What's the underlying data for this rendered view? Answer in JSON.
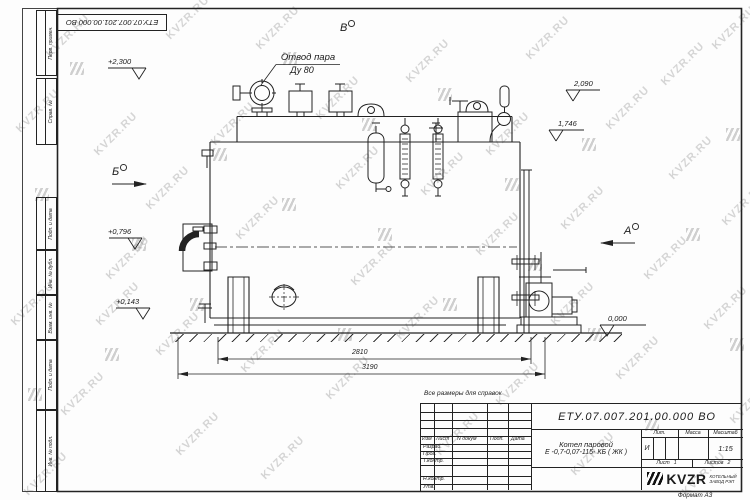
{
  "watermark_text": "KVZR.RU",
  "top_stamp": {
    "doc_number": "ЕТУ.07.007.201.00.000  ВО"
  },
  "margin": {
    "labels": {
      "l1": "Перв. примен.",
      "l2": "Справ. №",
      "l3": "Подп. и дата",
      "l4": "Инв. № дубл.",
      "l5": "Взам. инв. №",
      "l6": "Подп. и дата",
      "l7": "Инв. № подл."
    }
  },
  "drawing": {
    "note": "Все размеры для справок",
    "steam_outlet": {
      "line1": "Отвод пара",
      "line2": "Ду 80"
    },
    "views": {
      "v": "В",
      "b": "Б",
      "a": "А"
    },
    "elevations": {
      "e1": "+2,300",
      "e2": "2,090",
      "e3": "1,746",
      "e4": "+0,796",
      "e5": "+0,143",
      "e6": "0,000"
    },
    "dims": {
      "d1": "2810",
      "d2": "3190"
    }
  },
  "title_block": {
    "doc_number": "ЕТУ.07.007.201.00.000  ВО",
    "product_line1": "Котел паровой",
    "product_line2": "Е -0,7-0,07-115- КБ ( ЖК )",
    "cols": {
      "izm": "Изм",
      "list": "Лист",
      "ndoc": "N докум",
      "podp": "Подп.",
      "data": "Дата"
    },
    "rows": {
      "razrab": "Разраб.",
      "prov": "Пров.",
      "tkontr": "Т.контр.",
      "nkontr": "Н.контр.",
      "utv": "Утв."
    },
    "lit": {
      "label": "Лит.",
      "value": "И"
    },
    "massa": {
      "label": "Масса"
    },
    "scale": {
      "label": "Масштаб",
      "value": "1:15"
    },
    "sheet": {
      "label": "Лист",
      "value": "1"
    },
    "sheets": {
      "label": "Листов",
      "value": "2"
    },
    "company": {
      "name": "KVZR",
      "sub1": "КОТЕЛЬНЫЙ",
      "sub2": "ЗАВОД РЭП"
    },
    "format": "Формат  А3"
  }
}
